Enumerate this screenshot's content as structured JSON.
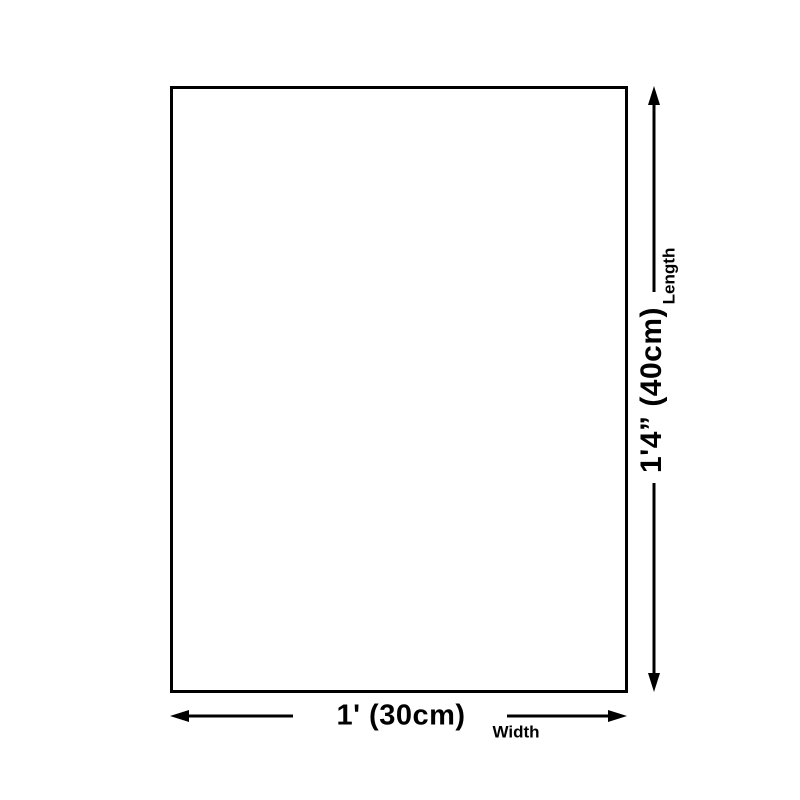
{
  "diagram": {
    "type": "product-dimension-diagram",
    "background_color": "#ffffff",
    "line_color": "#000000",
    "rectangle": {
      "description": "blank product outline"
    },
    "length_dimension": {
      "value": "1'4” (40cm)",
      "label": "Length",
      "orientation": "vertical"
    },
    "width_dimension": {
      "value": "1' (30cm)",
      "label": "Width",
      "orientation": "horizontal"
    }
  }
}
